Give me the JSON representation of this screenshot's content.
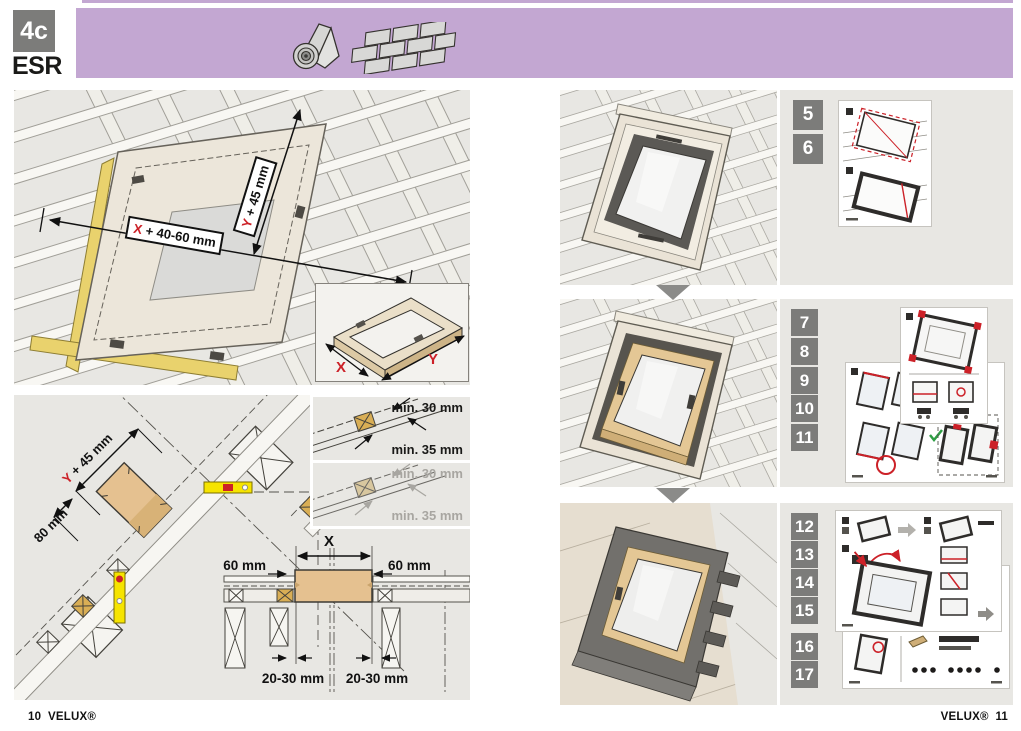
{
  "header": {
    "step_code": "4c",
    "product_code": "ESR",
    "icons": [
      "roofing-felt-roll",
      "shingles"
    ],
    "accent_purple": "#c3a7d2"
  },
  "frame_panel": {
    "dim_x": {
      "var": "X",
      "rest": " + 40-60 mm"
    },
    "dim_y": {
      "var": "Y",
      "rest": " + 45 mm"
    },
    "inset": {
      "x": "X",
      "y": "Y"
    }
  },
  "measure_panel": {
    "dim_y45": {
      "var": "Y",
      "rest": " + 45 mm"
    },
    "dim_80": "80 mm",
    "min_top": {
      "line1": "min. 30 mm",
      "line2": "min. 35 mm"
    },
    "min_bottom": {
      "line1": "min. 30 mm",
      "line2": "min. 35 mm"
    },
    "cross_section": {
      "dim_x": "X",
      "dim_60_left": "60 mm",
      "dim_60_right": "60 mm",
      "dim_2030_left": "20-30 mm",
      "dim_2030_right": "20-30 mm"
    }
  },
  "steps": {
    "group1": [
      "5",
      "6"
    ],
    "group2": [
      "7",
      "8",
      "9",
      "10",
      "11"
    ],
    "group3": [
      "12",
      "13",
      "14",
      "15",
      "16",
      "17"
    ]
  },
  "footer": {
    "left_page": "10",
    "brand": "VELUX®",
    "right_page": "11"
  },
  "colors": {
    "badge_gray": "#7c7c7a",
    "highlight_red": "#cc2128",
    "panel_gray": "#e8e7e3",
    "wood_tan": "#e5c190",
    "batten_yellow": "#e9d26d",
    "level_yellow": "#f6e400"
  }
}
